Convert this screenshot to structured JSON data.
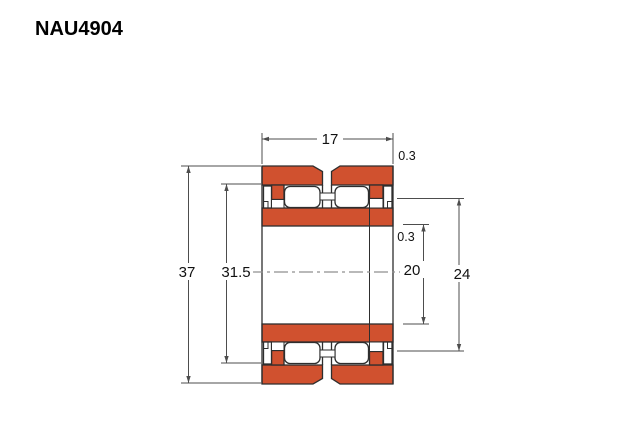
{
  "header": {
    "title": "NAU4904"
  },
  "drawing": {
    "type": "bearing-cross-section-diagram",
    "dimensions": {
      "outer_width": "17",
      "outer_chamfer": "0.3",
      "outer_diameter": "37",
      "outer_raceway": "31.5",
      "bore_chamfer": "0.3",
      "bore_diameter": "20",
      "inner_raceway": "24"
    },
    "colors": {
      "ring_fill": "#d0512f",
      "outline": "#2e2e2e",
      "dimension_line": "#4d4d4d",
      "centerline": "#8f8f8f"
    }
  }
}
